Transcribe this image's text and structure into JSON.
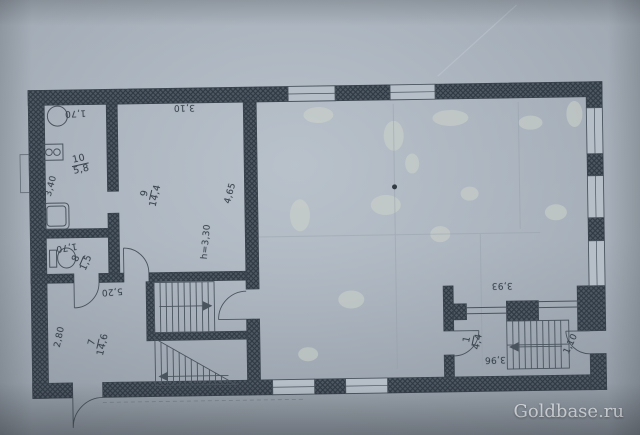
{
  "watermark": "Goldbase.ru",
  "plan": {
    "rooms": {
      "room10": {
        "number": "10",
        "area": "5,8"
      },
      "room9": {
        "number": "9",
        "area": "14,4"
      },
      "room8": {
        "number": "8",
        "area": "1,5"
      },
      "room7": {
        "number": "7",
        "area": "14,6"
      },
      "room1": {
        "number": "1",
        "area": "4,4"
      }
    },
    "dimensions": {
      "kitchen_width": "1,70",
      "kitchen_depth": "3,40",
      "room9_width": "3,10",
      "room9_depth": "4,65",
      "ceiling_height": "h=3,30",
      "toilet_length": "1,70",
      "toilet_width": "0,9",
      "room7_length": "5,20",
      "room7_depth": "2,80",
      "stair_hall_width": "3,93",
      "stair_hall_length": "3,96",
      "door_width": "1,10"
    },
    "colors": {
      "paper": "#aeb7c1",
      "wall": "#4c5662",
      "line": "#4a545e",
      "text": "#39434d"
    }
  }
}
